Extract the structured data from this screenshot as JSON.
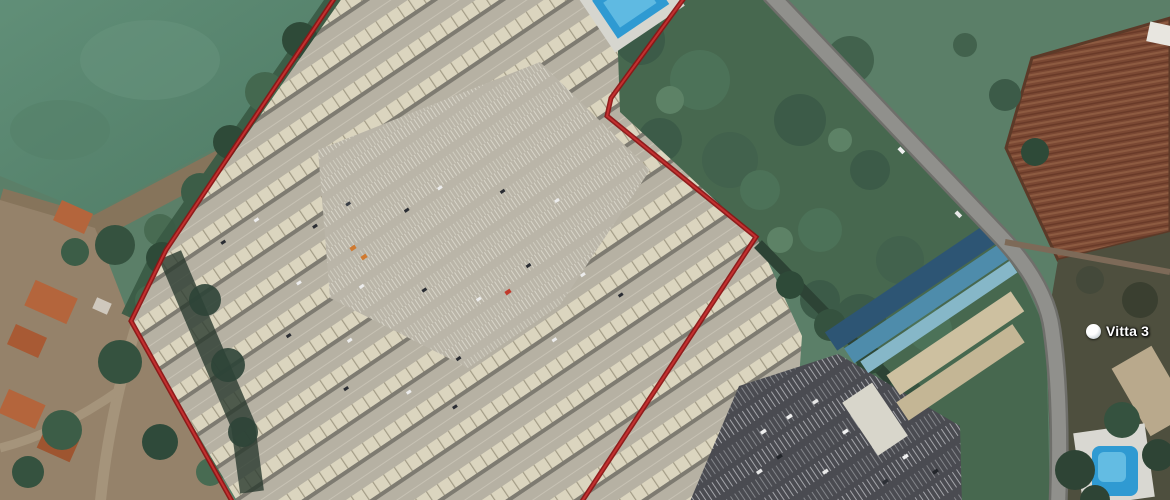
{
  "map": {
    "view_type": "satellite",
    "place_label": {
      "text": "Vitta 3",
      "icon": "map-pin-icon"
    },
    "boundary": {
      "stroke_outer": "#8c1515",
      "stroke_inner": "#c33030",
      "points": "340,-10 690,-10 611,98 607,116 756,237 575,512 238,512 131,321 166,250"
    },
    "palette": {
      "pool_water": "#2f9ad2",
      "pool_water_light": "#6cc2e6",
      "field_green": "#5d8a74",
      "scrub_green": "#47684f",
      "farm_brown": "#7a4833",
      "asphalt": "#4a4b51",
      "roof_beige": "#dbd5bf"
    }
  }
}
